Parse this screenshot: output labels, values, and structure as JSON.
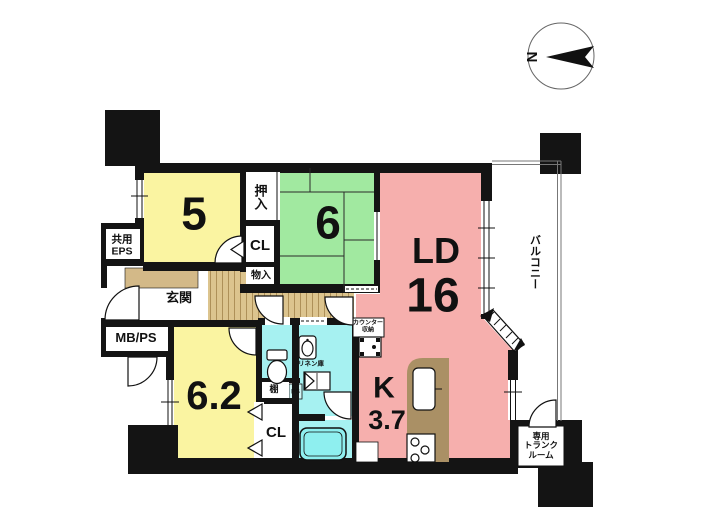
{
  "title": "マンション間取り図",
  "colors": {
    "wall": "#141414",
    "room_yellow": "#FAF4A1",
    "room_green": "#A1E9A0",
    "room_pink": "#F6AFAD",
    "water_cyan": "#A6F1F1",
    "wood": "#DCC48E",
    "wood_line": "#AE9058",
    "genkan_step": "#D3B988",
    "counter_brown": "#AA9065",
    "bathtub": "#8EEFEF"
  },
  "labels": {
    "room5": "5",
    "room6": "6",
    "room62": "6.2",
    "ld": "LD",
    "ld_size": "16",
    "kitchen": "K",
    "kitchen_size": "3.7",
    "oshiire": "押入",
    "cl_upper": "CL",
    "monoire": "物入",
    "genkan": "玄関",
    "kyoyo_eps_line1": "共用",
    "kyoyo_eps_line2": "EPS",
    "mb_ps": "MB/PS",
    "tana": "棚",
    "ps": "PS",
    "cl_lower": "CL",
    "linen": "リネン庫",
    "counter_line1": "カウンター",
    "counter_line2": "収納",
    "trunk_line1": "専用",
    "trunk_line2": "トランク",
    "trunk_line3": "ルーム",
    "balcony": "バルコニー",
    "north": "N"
  }
}
